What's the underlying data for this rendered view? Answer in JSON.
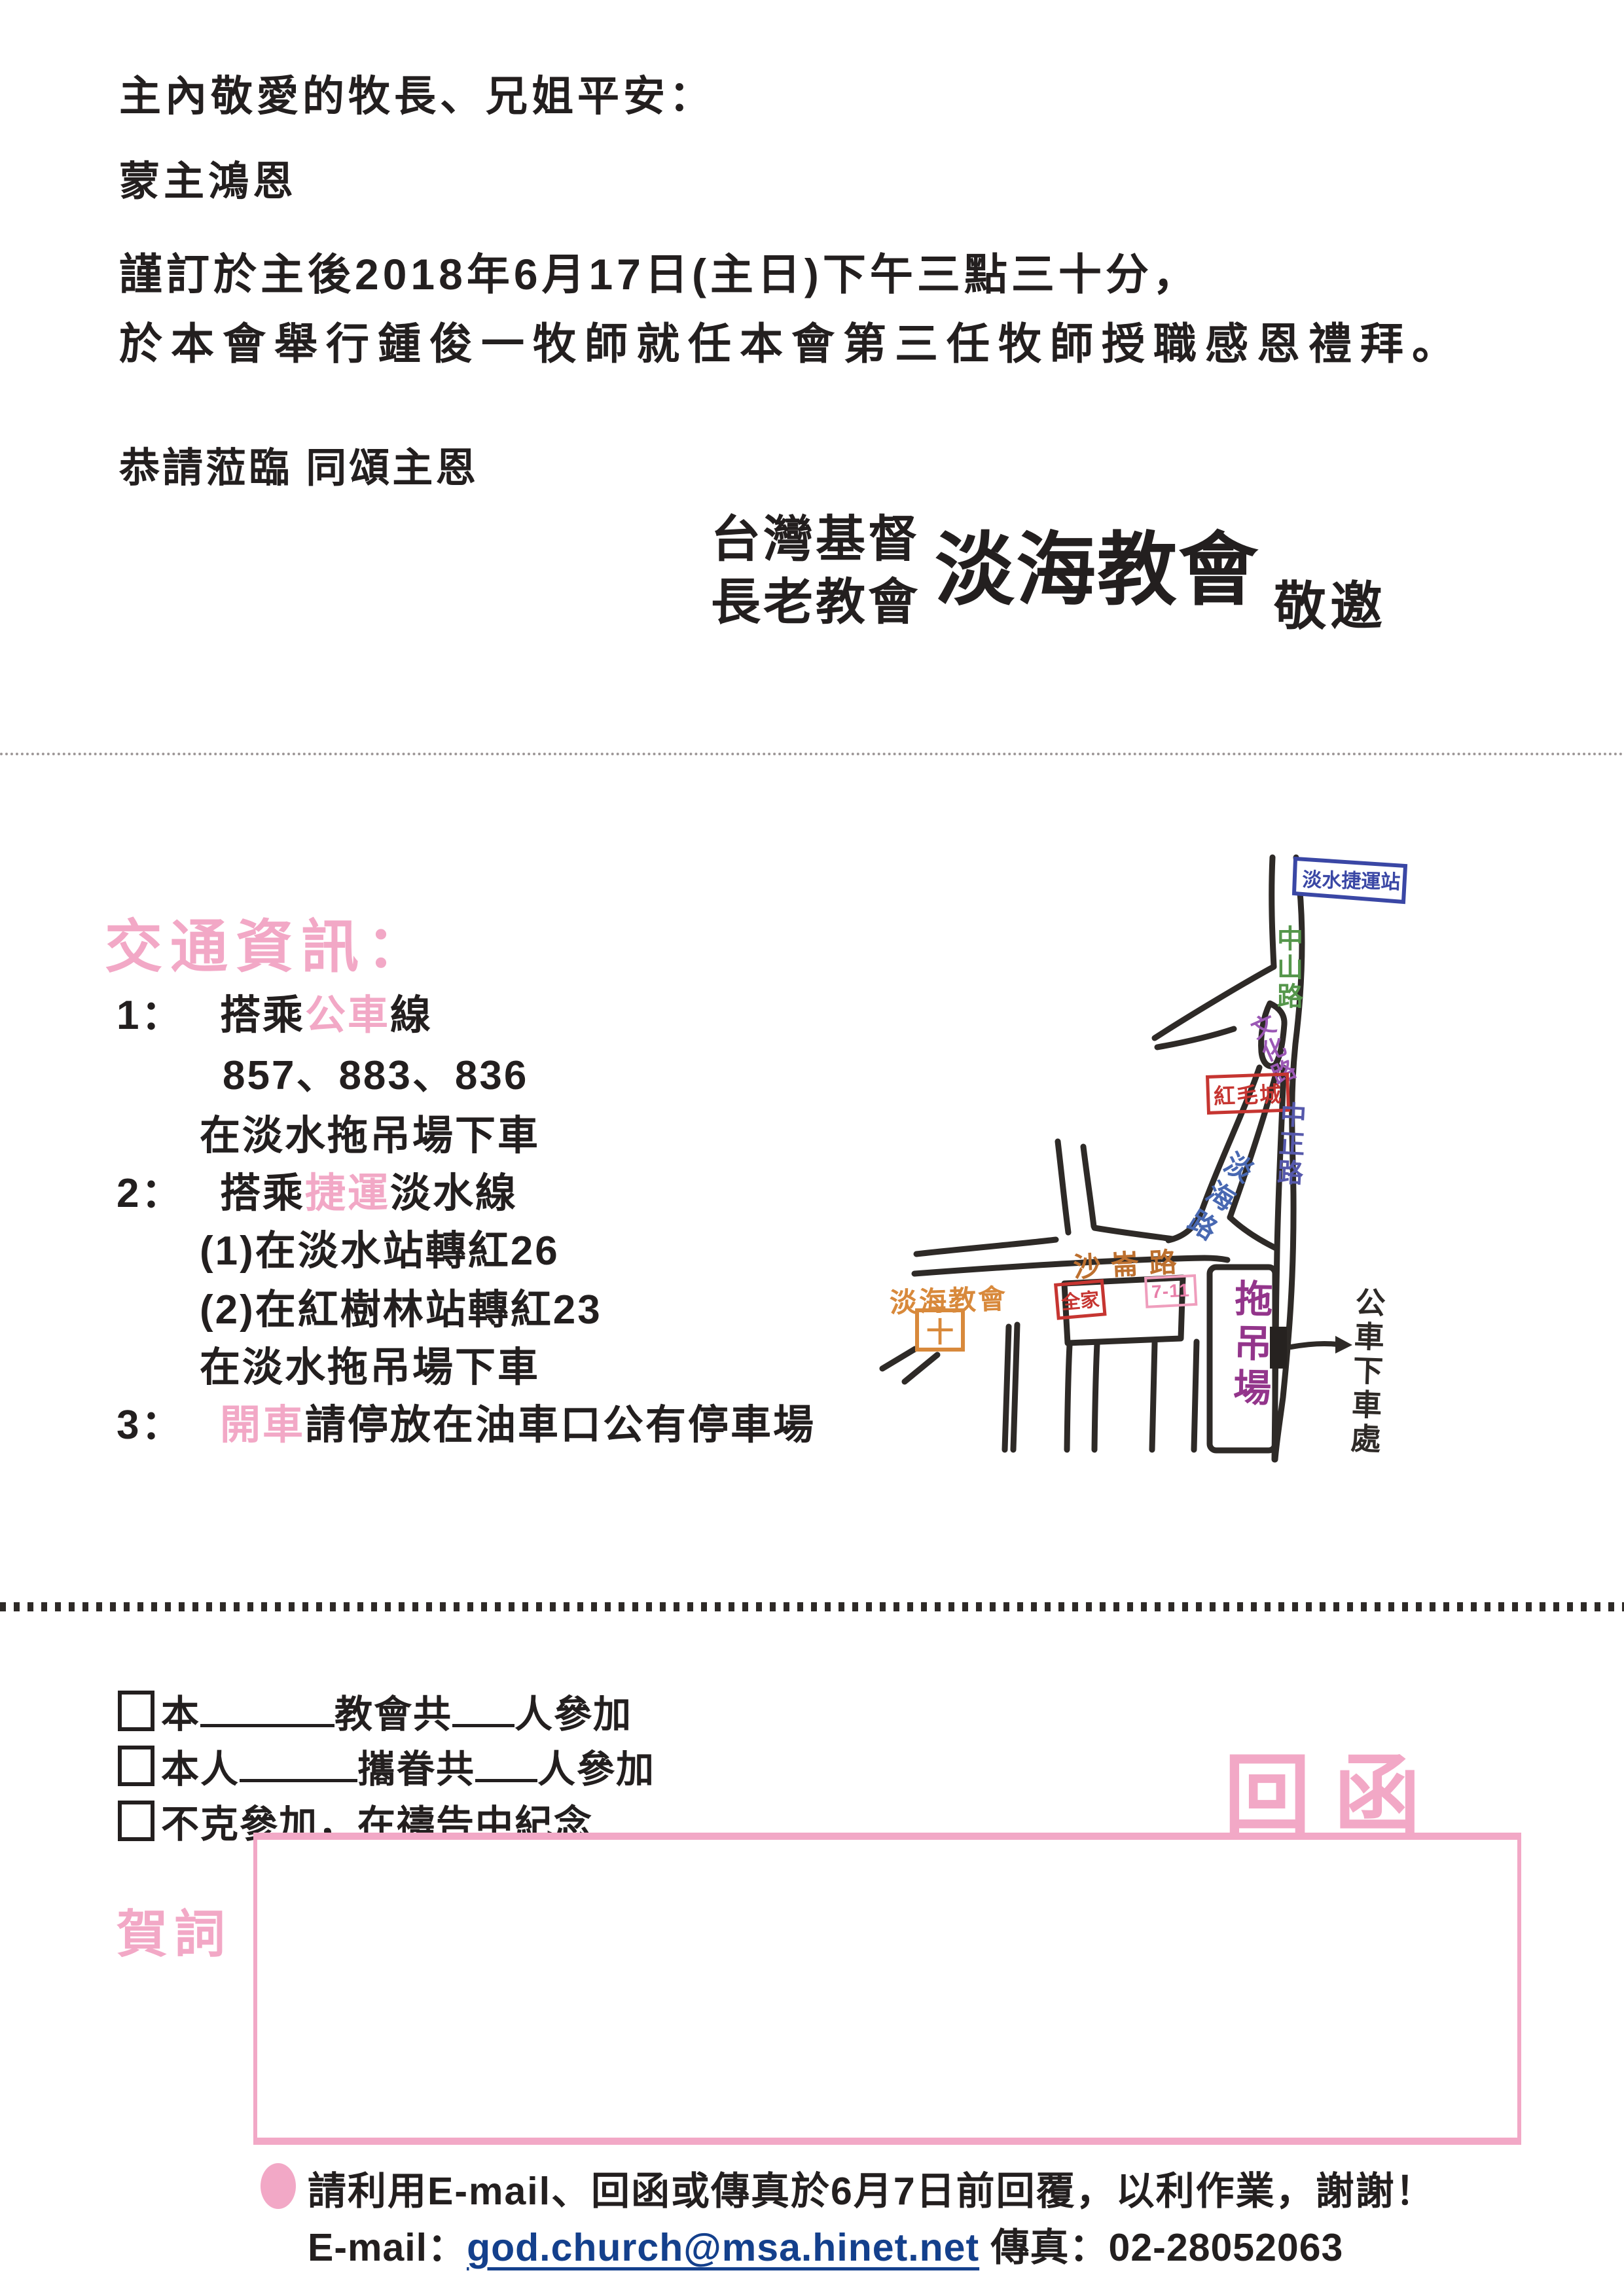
{
  "colors": {
    "accent_pink": "#f2a8c6",
    "ink": "#231f1f",
    "link_blue": "#14408c",
    "map_road": "#2e2a27",
    "map_blue": "#3a47a5",
    "map_green": "#55964b",
    "map_purple": "#9b58b5",
    "map_indigo": "#5558ab",
    "map_danhai_blue": "#4868b2",
    "map_orange": "#d8893b",
    "map_brown": "#bd702f",
    "map_red": "#c63531",
    "map_pink": "#ef9ebd",
    "map_magenta": "#93358b"
  },
  "intro": {
    "greeting": "主內敬愛的牧長、兄姐平安：",
    "grace": "蒙主鴻恩",
    "date_line": "謹訂於主後2018年6月17日(主日)下午三點三十分，",
    "event_line": "於本會舉行鍾俊一牧師就任本會第三任牧師授職感恩禮拜。",
    "closing": "恭請蒞臨 同頌主恩"
  },
  "inviter": {
    "org_line1": "台灣基督",
    "org_line2": "長老教會",
    "church_name": "淡海教會",
    "invite_word": "敬邀"
  },
  "transport": {
    "title": "交通資訊：",
    "lines": [
      {
        "indent": 0,
        "segments": [
          {
            "text": "1：",
            "num": true
          },
          {
            "text": "搭乘"
          },
          {
            "text": "公車",
            "accent": true
          },
          {
            "text": "線"
          }
        ]
      },
      {
        "indent": 2,
        "segments": [
          {
            "text": "857、883、836"
          }
        ]
      },
      {
        "indent": 1,
        "segments": [
          {
            "text": "在淡水拖吊場下車"
          }
        ]
      },
      {
        "indent": 0,
        "segments": [
          {
            "text": "2：",
            "num": true
          },
          {
            "text": "搭乘"
          },
          {
            "text": "捷運",
            "accent": true
          },
          {
            "text": "淡水線"
          }
        ]
      },
      {
        "indent": 1,
        "segments": [
          {
            "text": "(1)在淡水站轉紅26"
          }
        ]
      },
      {
        "indent": 1,
        "segments": [
          {
            "text": "(2)在紅樹林站轉紅23"
          }
        ]
      },
      {
        "indent": 1,
        "segments": [
          {
            "text": "在淡水拖吊場下車"
          }
        ]
      },
      {
        "indent": 0,
        "segments": [
          {
            "text": "3：",
            "num": true
          },
          {
            "text": "開車",
            "accent": true
          },
          {
            "text": "請停放在油車口公有停車場"
          }
        ]
      }
    ]
  },
  "map": {
    "station": "淡水捷運站",
    "road_zhongshan": "中山路",
    "road_wenhua": "文化路",
    "road_zhongzheng": "中正路",
    "road_danhai": "淡海路",
    "road_shalun": "沙崙路",
    "fort": "紅毛城",
    "family_mart": "全家",
    "seven_eleven": "7-11",
    "tow_yard": "拖吊場",
    "church": "淡海教會",
    "church_cross": "十",
    "bus_stop": "公車下車處"
  },
  "reply": {
    "title": "回函",
    "options": [
      {
        "segments": [
          {
            "checkbox": true
          },
          {
            "text": "本"
          },
          {
            "blank": "long"
          },
          {
            "text": "教會共"
          },
          {
            "blank": "short"
          },
          {
            "text": "人參加"
          }
        ]
      },
      {
        "segments": [
          {
            "checkbox": true
          },
          {
            "text": "本人"
          },
          {
            "blank": "mid"
          },
          {
            "text": "攜眷共"
          },
          {
            "blank": "short"
          },
          {
            "text": "人參加"
          }
        ]
      },
      {
        "segments": [
          {
            "checkbox": true
          },
          {
            "text": "不克參加，在禱告中紀念"
          }
        ]
      }
    ],
    "congrats_label": "賀詞"
  },
  "footer": {
    "note": "請利用E-mail、回函或傳真於6月7日前回覆，以利作業，謝謝！",
    "email_label": "E-mail：",
    "email": "god.church@msa.hinet.net",
    "fax_label": "傳真：",
    "fax": "02-28052063"
  }
}
